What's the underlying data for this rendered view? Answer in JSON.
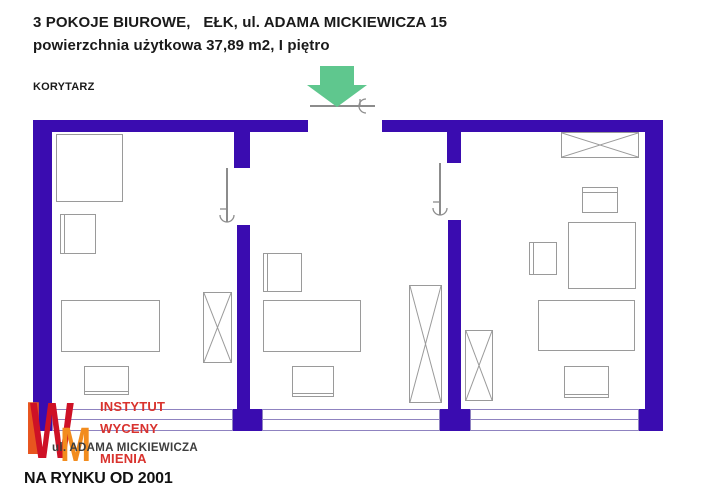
{
  "header": {
    "line1": "3 POKOJE BIUROWE,   EŁK, ul. ADAMA MICKIEWICZA 15",
    "line2": "powierzchnia użytkowa 37,89 m2, I piętro",
    "corridor": "KORYTARZ"
  },
  "logo": {
    "letter_i": "I",
    "letter_w": "W",
    "letter_m": "M",
    "line1": "INSTYTUT",
    "line2": "WYCENY",
    "line3": "MIENIA",
    "street": "ul. ADAMA MICKIEWICZA",
    "tagline": "NA RYNKU OD 2001"
  },
  "colors": {
    "wall": "#3A0CB0",
    "window_line": "#8F83C0",
    "furniture_line": "#9A9A9A",
    "door_line": "#8C8C8C",
    "arrow_green": "#5FC78E",
    "logo_i": "#E8551F",
    "logo_w": "#CE1126",
    "logo_m": "#F28C1E",
    "logo_text_red": "#D9332E",
    "street_gray": "#3D3D3D",
    "tagline_black": "#111111",
    "title_black": "#1A1A1A"
  },
  "floorplan": {
    "walls": [
      {
        "name": "top-wall-left",
        "x": 33,
        "y": 120,
        "w": 275,
        "h": 12
      },
      {
        "name": "top-wall-right",
        "x": 382,
        "y": 120,
        "w": 281,
        "h": 12
      },
      {
        "name": "left-wall",
        "x": 33,
        "y": 120,
        "w": 19,
        "h": 311
      },
      {
        "name": "right-wall",
        "x": 645,
        "y": 120,
        "w": 18,
        "h": 311
      },
      {
        "name": "divider1-top",
        "x": 234,
        "y": 131,
        "w": 16,
        "h": 37
      },
      {
        "name": "divider1-main",
        "x": 237,
        "y": 225,
        "w": 13,
        "h": 184
      },
      {
        "name": "divider1-base",
        "x": 233,
        "y": 409,
        "w": 29,
        "h": 22
      },
      {
        "name": "divider2-top",
        "x": 447,
        "y": 131,
        "w": 14,
        "h": 32
      },
      {
        "name": "divider2-main",
        "x": 448,
        "y": 220,
        "w": 13,
        "h": 189
      },
      {
        "name": "divider2-base",
        "x": 440,
        "y": 409,
        "w": 30,
        "h": 22
      },
      {
        "name": "right-wall-base",
        "x": 639,
        "y": 409,
        "w": 7,
        "h": 22
      }
    ],
    "windows": [
      {
        "name": "window-room1",
        "x": 52,
        "y": 409,
        "w": 181,
        "h": 22
      },
      {
        "name": "window-room2",
        "x": 262,
        "y": 409,
        "w": 178,
        "h": 22
      },
      {
        "name": "window-room3",
        "x": 470,
        "y": 409,
        "w": 169,
        "h": 22
      }
    ],
    "furniture": [
      {
        "name": "room1-cabinet-large",
        "type": "rect",
        "x": 56,
        "y": 134,
        "w": 67,
        "h": 68
      },
      {
        "name": "room1-cabinet-small",
        "type": "rect-l",
        "x": 60,
        "y": 214,
        "w": 36,
        "h": 40
      },
      {
        "name": "room1-desk",
        "type": "rect",
        "x": 61,
        "y": 300,
        "w": 99,
        "h": 52
      },
      {
        "name": "room1-chair",
        "type": "rect-b",
        "x": 84,
        "y": 366,
        "w": 45,
        "h": 29
      },
      {
        "name": "room1-wardrobe",
        "type": "x",
        "x": 203,
        "y": 292,
        "w": 29,
        "h": 71
      },
      {
        "name": "room2-cabinet",
        "type": "rect-l",
        "x": 263,
        "y": 253,
        "w": 39,
        "h": 39
      },
      {
        "name": "room2-desk",
        "type": "rect",
        "x": 263,
        "y": 300,
        "w": 98,
        "h": 52
      },
      {
        "name": "room2-chair",
        "type": "rect-b",
        "x": 292,
        "y": 366,
        "w": 42,
        "h": 31
      },
      {
        "name": "room2-wardrobe",
        "type": "x",
        "x": 409,
        "y": 285,
        "w": 33,
        "h": 118
      },
      {
        "name": "room3-shelf",
        "type": "x",
        "x": 561,
        "y": 132,
        "w": 78,
        "h": 26
      },
      {
        "name": "room3-cabinet-top",
        "type": "rect-t",
        "x": 582,
        "y": 187,
        "w": 36,
        "h": 26
      },
      {
        "name": "room3-table",
        "type": "rect",
        "x": 568,
        "y": 222,
        "w": 68,
        "h": 67
      },
      {
        "name": "room3-cabinet-small",
        "type": "rect-l",
        "x": 529,
        "y": 242,
        "w": 28,
        "h": 33
      },
      {
        "name": "room3-desk",
        "type": "rect",
        "x": 538,
        "y": 300,
        "w": 97,
        "h": 51
      },
      {
        "name": "room3-chair",
        "type": "rect-b",
        "x": 564,
        "y": 366,
        "w": 45,
        "h": 32
      },
      {
        "name": "room3-wardrobe",
        "type": "x",
        "x": 465,
        "y": 330,
        "w": 28,
        "h": 71
      }
    ],
    "doors": [
      {
        "name": "entrance-door",
        "orient": "h",
        "x": 310,
        "y": 105,
        "len": 65
      },
      {
        "name": "door-room1",
        "orient": "v",
        "x": 227,
        "y": 168,
        "len": 54
      },
      {
        "name": "door-room2",
        "orient": "v",
        "x": 440,
        "y": 163,
        "len": 52
      }
    ],
    "arrow": {
      "x": 306,
      "y": 64,
      "w": 62,
      "h": 44
    }
  }
}
